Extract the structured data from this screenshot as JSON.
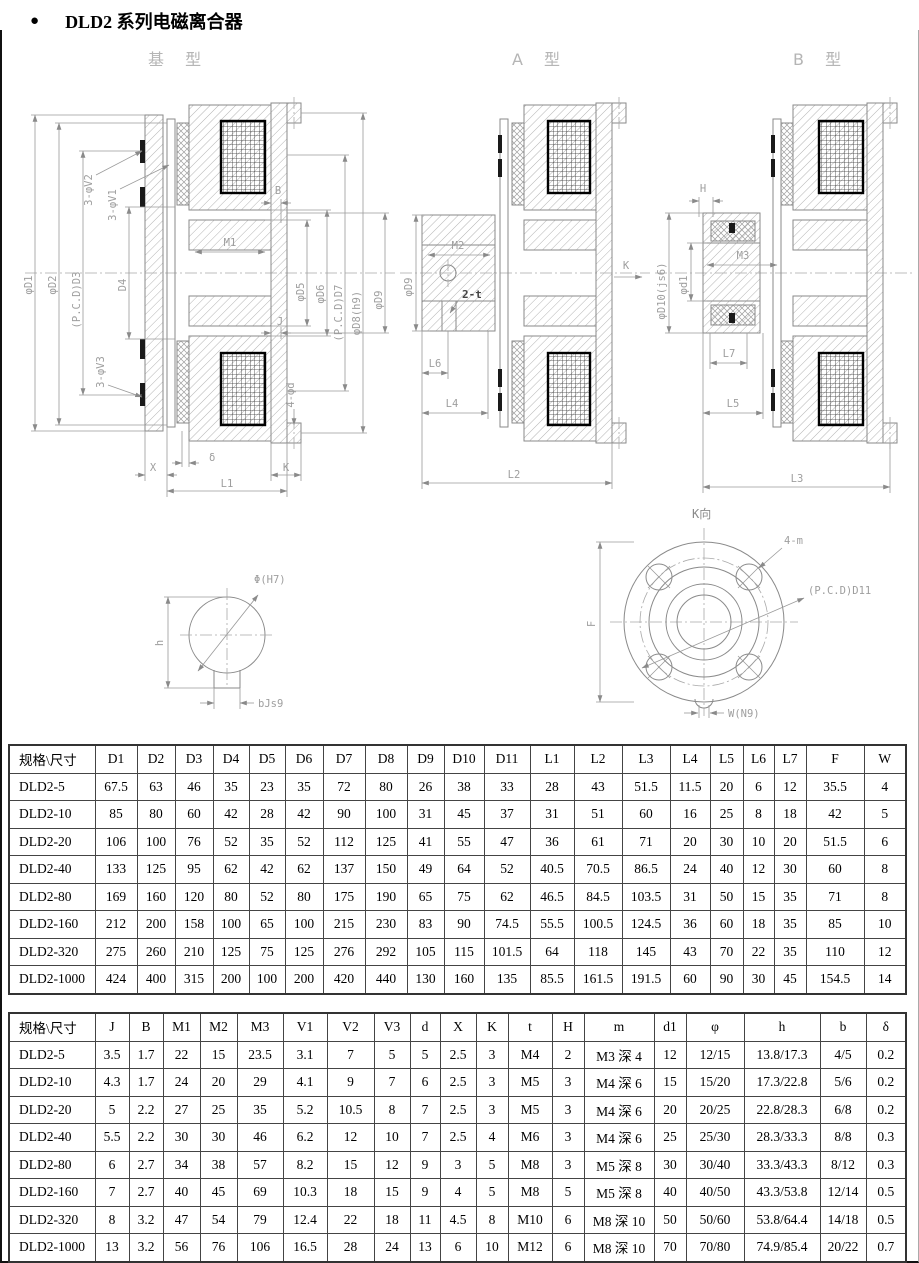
{
  "page": {
    "bullet": "●",
    "title": "DLD2 系列电磁离合器"
  },
  "drawings": {
    "base": {
      "label": "基 型",
      "dims": {
        "d1": "φD1",
        "d2": "φD2",
        "d3": "(P.C.D)D3",
        "d4": "D4",
        "v2": "3-φV2",
        "v1": "3-φV1",
        "v3": "3-φV3",
        "b": "B",
        "m1": "M1",
        "j": "J",
        "d5": "φD5",
        "d6": "φD6",
        "d7": "(P.C.D)D7",
        "d8": "φD8(h9)",
        "d9": "φD9",
        "phid": "4-φd",
        "delta": "δ",
        "x": "X",
        "k": "K",
        "l1": "L1"
      }
    },
    "typeA": {
      "label": "A 型",
      "dims": {
        "d9": "φD9",
        "m2": "M2",
        "t": "2-t",
        "l6": "L6",
        "l4": "L4",
        "l2": "L2",
        "k": "K"
      }
    },
    "typeB": {
      "label": "B 型",
      "dims": {
        "h": "H",
        "d10": "φD10(js6)",
        "d1": "φd1",
        "m3": "M3",
        "l7": "L7",
        "l5": "L5",
        "l3": "L3"
      }
    },
    "keyway": {
      "dims": {
        "phi": "Φ(H7)",
        "h": "h",
        "b": "bJs9"
      }
    },
    "kview": {
      "label": "K向",
      "dims": {
        "m": "4-m",
        "pcd": "(P.C.D)D11",
        "f": "F",
        "w": "W(N9)"
      }
    }
  },
  "table1": {
    "headers": [
      "规格\\尺寸",
      "D1",
      "D2",
      "D3",
      "D4",
      "D5",
      "D6",
      "D7",
      "D8",
      "D9",
      "D10",
      "D11",
      "L1",
      "L2",
      "L3",
      "L4",
      "L5",
      "L6",
      "L7",
      "F",
      "W"
    ],
    "rows": [
      [
        "DLD2-5",
        "67.5",
        "63",
        "46",
        "35",
        "23",
        "35",
        "72",
        "80",
        "26",
        "38",
        "33",
        "28",
        "43",
        "51.5",
        "11.5",
        "20",
        "6",
        "12",
        "35.5",
        "4"
      ],
      [
        "DLD2-10",
        "85",
        "80",
        "60",
        "42",
        "28",
        "42",
        "90",
        "100",
        "31",
        "45",
        "37",
        "31",
        "51",
        "60",
        "16",
        "25",
        "8",
        "18",
        "42",
        "5"
      ],
      [
        "DLD2-20",
        "106",
        "100",
        "76",
        "52",
        "35",
        "52",
        "112",
        "125",
        "41",
        "55",
        "47",
        "36",
        "61",
        "71",
        "20",
        "30",
        "10",
        "20",
        "51.5",
        "6"
      ],
      [
        "DLD2-40",
        "133",
        "125",
        "95",
        "62",
        "42",
        "62",
        "137",
        "150",
        "49",
        "64",
        "52",
        "40.5",
        "70.5",
        "86.5",
        "24",
        "40",
        "12",
        "30",
        "60",
        "8"
      ],
      [
        "DLD2-80",
        "169",
        "160",
        "120",
        "80",
        "52",
        "80",
        "175",
        "190",
        "65",
        "75",
        "62",
        "46.5",
        "84.5",
        "103.5",
        "31",
        "50",
        "15",
        "35",
        "71",
        "8"
      ],
      [
        "DLD2-160",
        "212",
        "200",
        "158",
        "100",
        "65",
        "100",
        "215",
        "230",
        "83",
        "90",
        "74.5",
        "55.5",
        "100.5",
        "124.5",
        "36",
        "60",
        "18",
        "35",
        "85",
        "10"
      ],
      [
        "DLD2-320",
        "275",
        "260",
        "210",
        "125",
        "75",
        "125",
        "276",
        "292",
        "105",
        "115",
        "101.5",
        "64",
        "118",
        "145",
        "43",
        "70",
        "22",
        "35",
        "110",
        "12"
      ],
      [
        "DLD2-1000",
        "424",
        "400",
        "315",
        "200",
        "100",
        "200",
        "420",
        "440",
        "130",
        "160",
        "135",
        "85.5",
        "161.5",
        "191.5",
        "60",
        "90",
        "30",
        "45",
        "154.5",
        "14"
      ]
    ]
  },
  "table2": {
    "headers": [
      "规格\\尺寸",
      "J",
      "B",
      "M1",
      "M2",
      "M3",
      "V1",
      "V2",
      "V3",
      "d",
      "X",
      "K",
      "t",
      "H",
      "m",
      "d1",
      "φ",
      "h",
      "b",
      "δ"
    ],
    "rows": [
      [
        "DLD2-5",
        "3.5",
        "1.7",
        "22",
        "15",
        "23.5",
        "3.1",
        "7",
        "5",
        "5",
        "2.5",
        "3",
        "M4",
        "2",
        "M3 深 4",
        "12",
        "12/15",
        "13.8/17.3",
        "4/5",
        "0.2"
      ],
      [
        "DLD2-10",
        "4.3",
        "1.7",
        "24",
        "20",
        "29",
        "4.1",
        "9",
        "7",
        "6",
        "2.5",
        "3",
        "M5",
        "3",
        "M4 深 6",
        "15",
        "15/20",
        "17.3/22.8",
        "5/6",
        "0.2"
      ],
      [
        "DLD2-20",
        "5",
        "2.2",
        "27",
        "25",
        "35",
        "5.2",
        "10.5",
        "8",
        "7",
        "2.5",
        "3",
        "M5",
        "3",
        "M4 深 6",
        "20",
        "20/25",
        "22.8/28.3",
        "6/8",
        "0.2"
      ],
      [
        "DLD2-40",
        "5.5",
        "2.2",
        "30",
        "30",
        "46",
        "6.2",
        "12",
        "10",
        "7",
        "2.5",
        "4",
        "M6",
        "3",
        "M4 深 6",
        "25",
        "25/30",
        "28.3/33.3",
        "8/8",
        "0.3"
      ],
      [
        "DLD2-80",
        "6",
        "2.7",
        "34",
        "38",
        "57",
        "8.2",
        "15",
        "12",
        "9",
        "3",
        "5",
        "M8",
        "3",
        "M5 深 8",
        "30",
        "30/40",
        "33.3/43.3",
        "8/12",
        "0.3"
      ],
      [
        "DLD2-160",
        "7",
        "2.7",
        "40",
        "45",
        "69",
        "10.3",
        "18",
        "15",
        "9",
        "4",
        "5",
        "M8",
        "5",
        "M5 深 8",
        "40",
        "40/50",
        "43.3/53.8",
        "12/14",
        "0.5"
      ],
      [
        "DLD2-320",
        "8",
        "3.2",
        "47",
        "54",
        "79",
        "12.4",
        "22",
        "18",
        "11",
        "4.5",
        "8",
        "M10",
        "6",
        "M8 深 10",
        "50",
        "50/60",
        "53.8/64.4",
        "14/18",
        "0.5"
      ],
      [
        "DLD2-1000",
        "13",
        "3.2",
        "56",
        "76",
        "106",
        "16.5",
        "28",
        "24",
        "13",
        "6",
        "10",
        "M12",
        "6",
        "M8 深 10",
        "70",
        "70/80",
        "74.9/85.4",
        "20/22",
        "0.7"
      ]
    ]
  }
}
